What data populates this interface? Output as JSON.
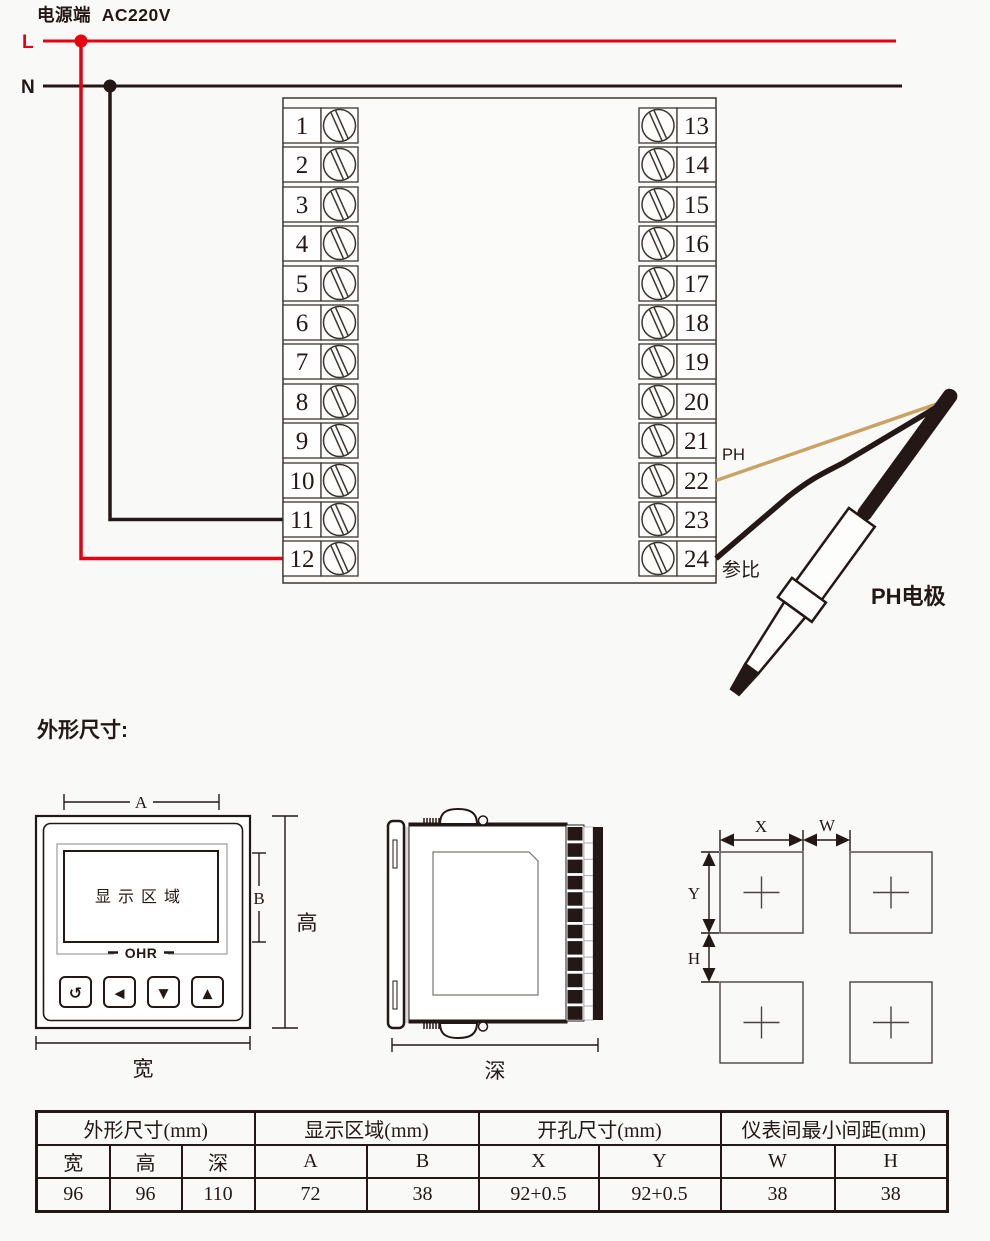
{
  "power": {
    "title": "电源端  AC220V",
    "line_l": "L",
    "line_n": "N"
  },
  "wiring": {
    "terminals_left": [
      "1",
      "2",
      "3",
      "4",
      "5",
      "6",
      "7",
      "8",
      "9",
      "10",
      "11",
      "12"
    ],
    "terminals_right": [
      "13",
      "14",
      "15",
      "16",
      "17",
      "18",
      "19",
      "20",
      "21",
      "22",
      "23",
      "24"
    ],
    "ph_wire_label": "PH",
    "reference_wire_label": "参比",
    "electrode_label": "PH电极"
  },
  "outline": {
    "section_title": "外形尺寸:",
    "front_view": {
      "display_label": "显示区域",
      "brand": "OHR",
      "dim_a": "A",
      "dim_b": "B",
      "dim_height": "高",
      "dim_width": "宽",
      "buttons": [
        "↺",
        "◀",
        "▼",
        "▲"
      ]
    },
    "side_view": {
      "dim_depth": "深"
    },
    "cutout_view": {
      "dim_x": "X",
      "dim_w": "W",
      "dim_y": "Y",
      "dim_h": "H"
    }
  },
  "spec_table": {
    "group_labels": [
      "外形尺寸(mm)",
      "显示区域(mm)",
      "开孔尺寸(mm)",
      "仪表间最小间距(mm)"
    ],
    "headers": [
      "宽",
      "高",
      "深",
      "A",
      "B",
      "X",
      "Y",
      "W",
      "H"
    ],
    "values": [
      "96",
      "96",
      "110",
      "72",
      "38",
      "92+0.5",
      "92+0.5",
      "38",
      "38"
    ]
  },
  "colors": {
    "live_wire": "#e60012",
    "neutral_wire": "#231815",
    "ph_wire": "#c9a264",
    "ink": "#231815"
  }
}
